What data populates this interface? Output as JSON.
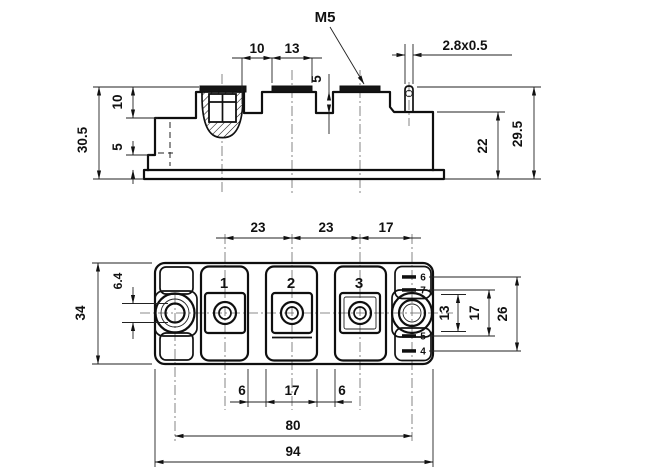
{
  "side_view": {
    "thread_label": "M5",
    "tab_cross_section": "2.8x0.5",
    "dim_total_height": "30.5",
    "dim_top_step": "10",
    "dim_flange_height": "5",
    "dim_terminal_gap": "10",
    "dim_pad_width": "13",
    "dim_notch_depth": "5",
    "dim_case_height": "22",
    "dim_tab_height": "29.5"
  },
  "plan_view": {
    "terminals": [
      "1",
      "2",
      "3"
    ],
    "pins": [
      "6",
      "7",
      "5",
      "4"
    ],
    "dim_pitch_t1_t2": "23",
    "dim_pitch_t2_t3": "23",
    "dim_t3_to_hole": "17",
    "dim_width": "34",
    "dim_hole_dia": "6.4",
    "dim_pin_span_inner": "13",
    "dim_pin_span_mid": "17",
    "dim_pin_span_outer": "26",
    "dim_groove_left": "6",
    "dim_center_block": "17",
    "dim_groove_right": "6",
    "dim_hole_pitch": "80",
    "dim_length": "94"
  }
}
